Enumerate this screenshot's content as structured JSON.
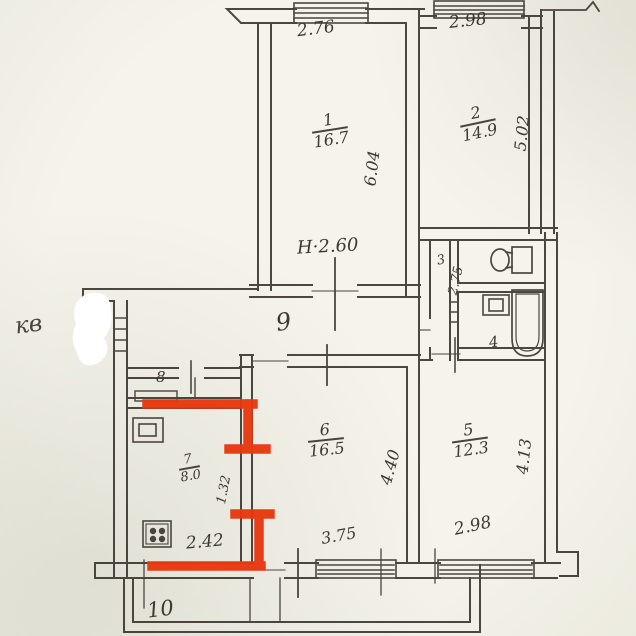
{
  "plan": {
    "handwritten_note": "кв",
    "ceiling_height": "Н·2.60",
    "rooms": {
      "room1": {
        "number": "1",
        "area": "16.7"
      },
      "room2": {
        "number": "2",
        "area": "14.9"
      },
      "room3": {
        "number": "3"
      },
      "room4": {
        "number": "4"
      },
      "room5": {
        "number": "5",
        "area": "12.3"
      },
      "room6": {
        "number": "6",
        "area": "16.5"
      },
      "room7": {
        "number": "7",
        "area": "8.0"
      },
      "room8": {
        "number": "8"
      },
      "room9": {
        "number": "9"
      },
      "room10": {
        "number": "10"
      }
    },
    "dimensions": {
      "room1_width": "2.76",
      "room1_depth": "6.04",
      "room2_width": "2.98",
      "room2_depth": "5.02",
      "corridor_depth": "2.75",
      "room5_width": "2.98",
      "room5_depth": "4.13",
      "room6_width": "3.75",
      "room6_depth": "4.40",
      "room7_width": "2.42",
      "room7_dim": "1.32"
    },
    "colors": {
      "paper": "#f2f0e7",
      "ink": "#3d3831",
      "marker_red": "#e8380f"
    }
  }
}
